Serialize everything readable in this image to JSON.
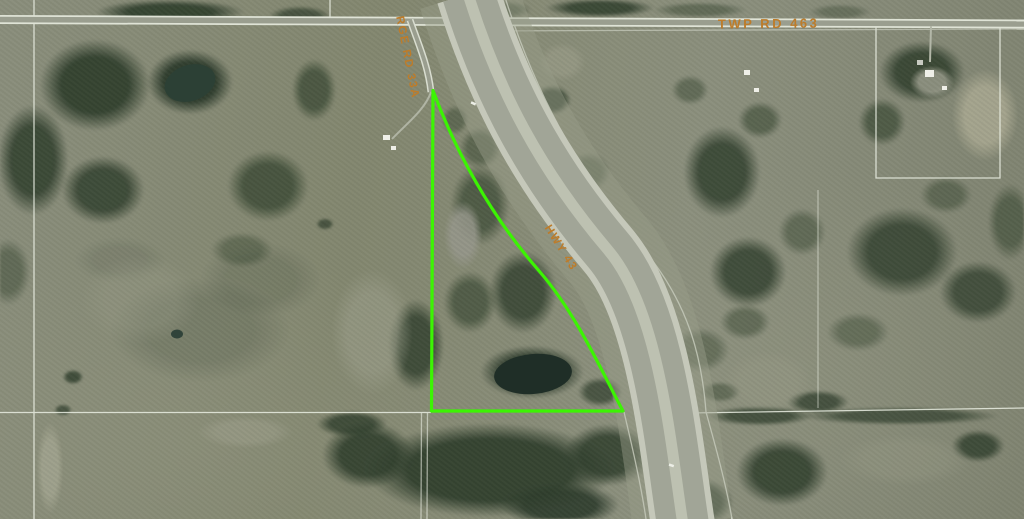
{
  "map": {
    "labels": {
      "twp_road": "TWP RD 463",
      "rge_road": "RGE RD 33A",
      "highway": "HWY 43"
    },
    "colors": {
      "parcel_outline": "#3CF403",
      "road_label": "#BD7C2A",
      "survey_line": "#E9EDE2",
      "highway_pavement": "#A1A597",
      "water": "#1F2E27"
    },
    "parcel": {
      "path": "M 433,90.5 C 455,150 490,215 540,272 C 577,315 602,372 623,411 L 431.5,411 Z"
    }
  }
}
